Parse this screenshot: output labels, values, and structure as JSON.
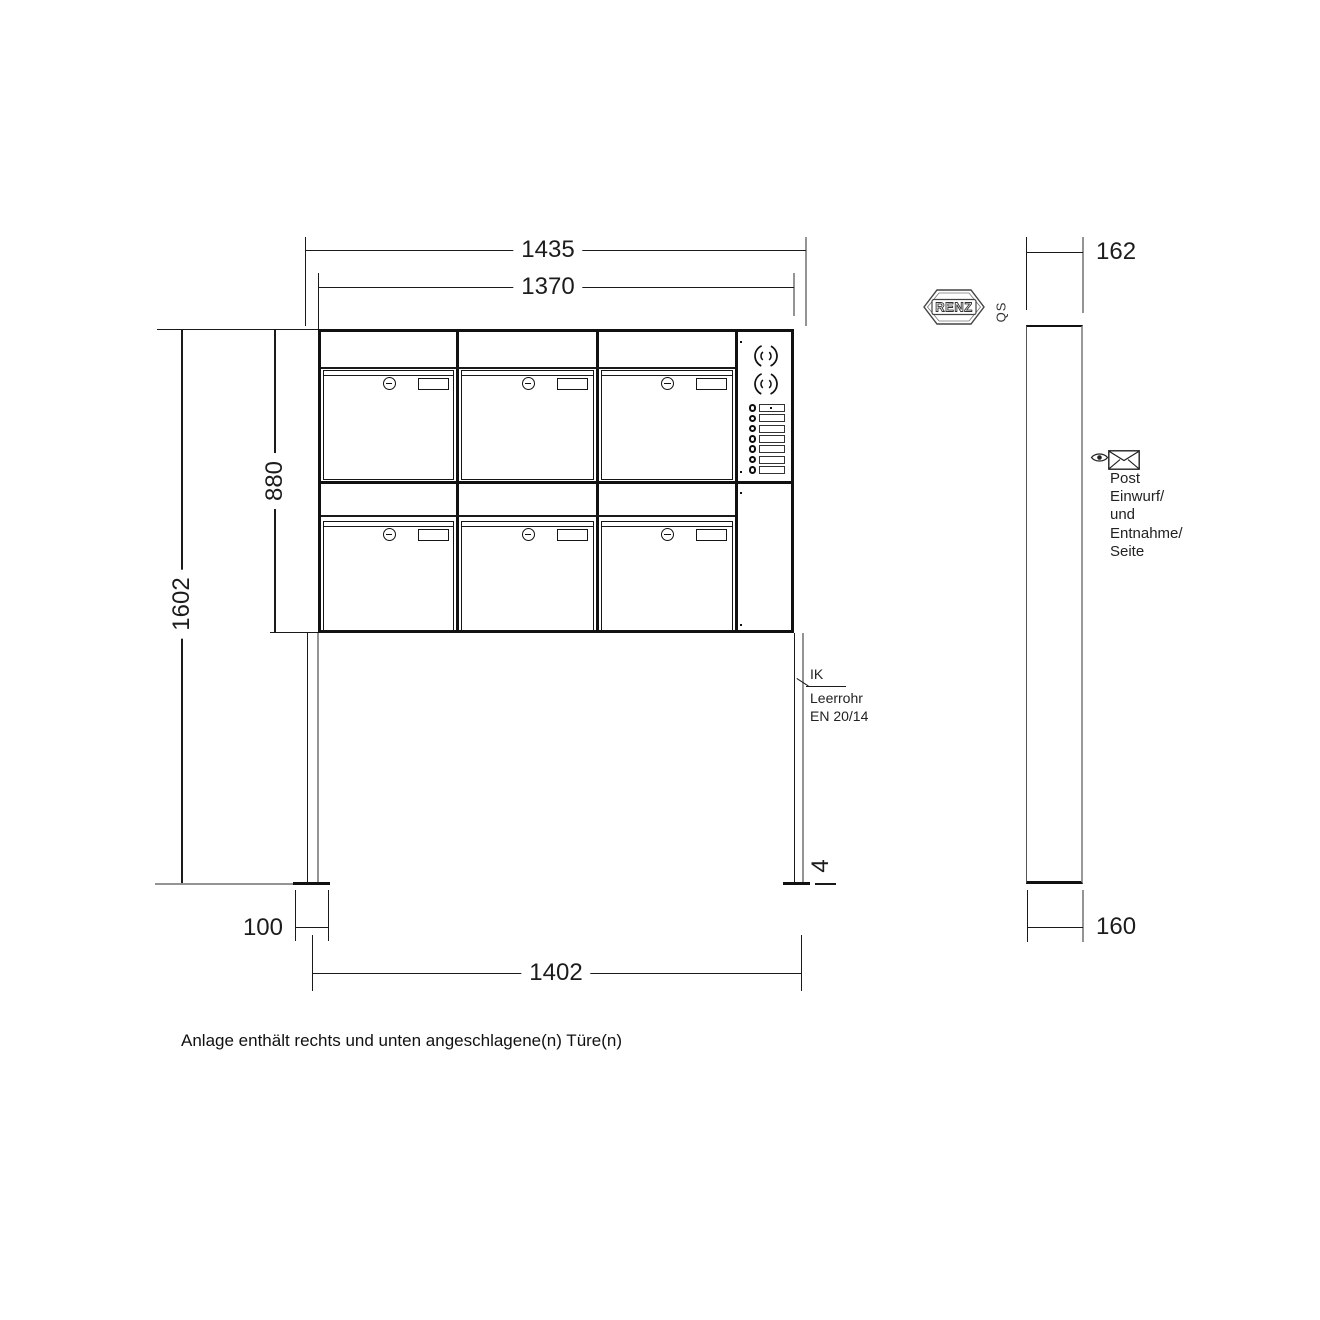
{
  "drawing": {
    "caption": "Anlage enthält rechts und unten angeschlagene(n) Türe(n)",
    "brand": {
      "logo_text": "RENZ",
      "qs_label": "QS"
    },
    "front_view": {
      "dimensions": {
        "overall_width": "1435",
        "box_row_width": "1370",
        "box_block_height": "880",
        "total_height": "1602",
        "post_width": "100",
        "post_spacing": "1402",
        "base_plate_thickness": "4"
      },
      "conduit_note": {
        "line1": "IK",
        "line2": "Leerrohr",
        "line3": "EN 20/14"
      },
      "cabinet": {
        "mailbox_columns": 3,
        "mailbox_rows": 2,
        "bell_buttons": 7
      }
    },
    "side_view": {
      "dimensions": {
        "depth_top": "162",
        "depth_bottom": "160"
      },
      "access_note_lines": [
        "Post",
        "Einwurf/",
        "und",
        "Entnahme/",
        "Seite"
      ]
    },
    "colors": {
      "line": "#1a1a1a",
      "extension_gray": "#949494",
      "background": "#ffffff"
    }
  }
}
